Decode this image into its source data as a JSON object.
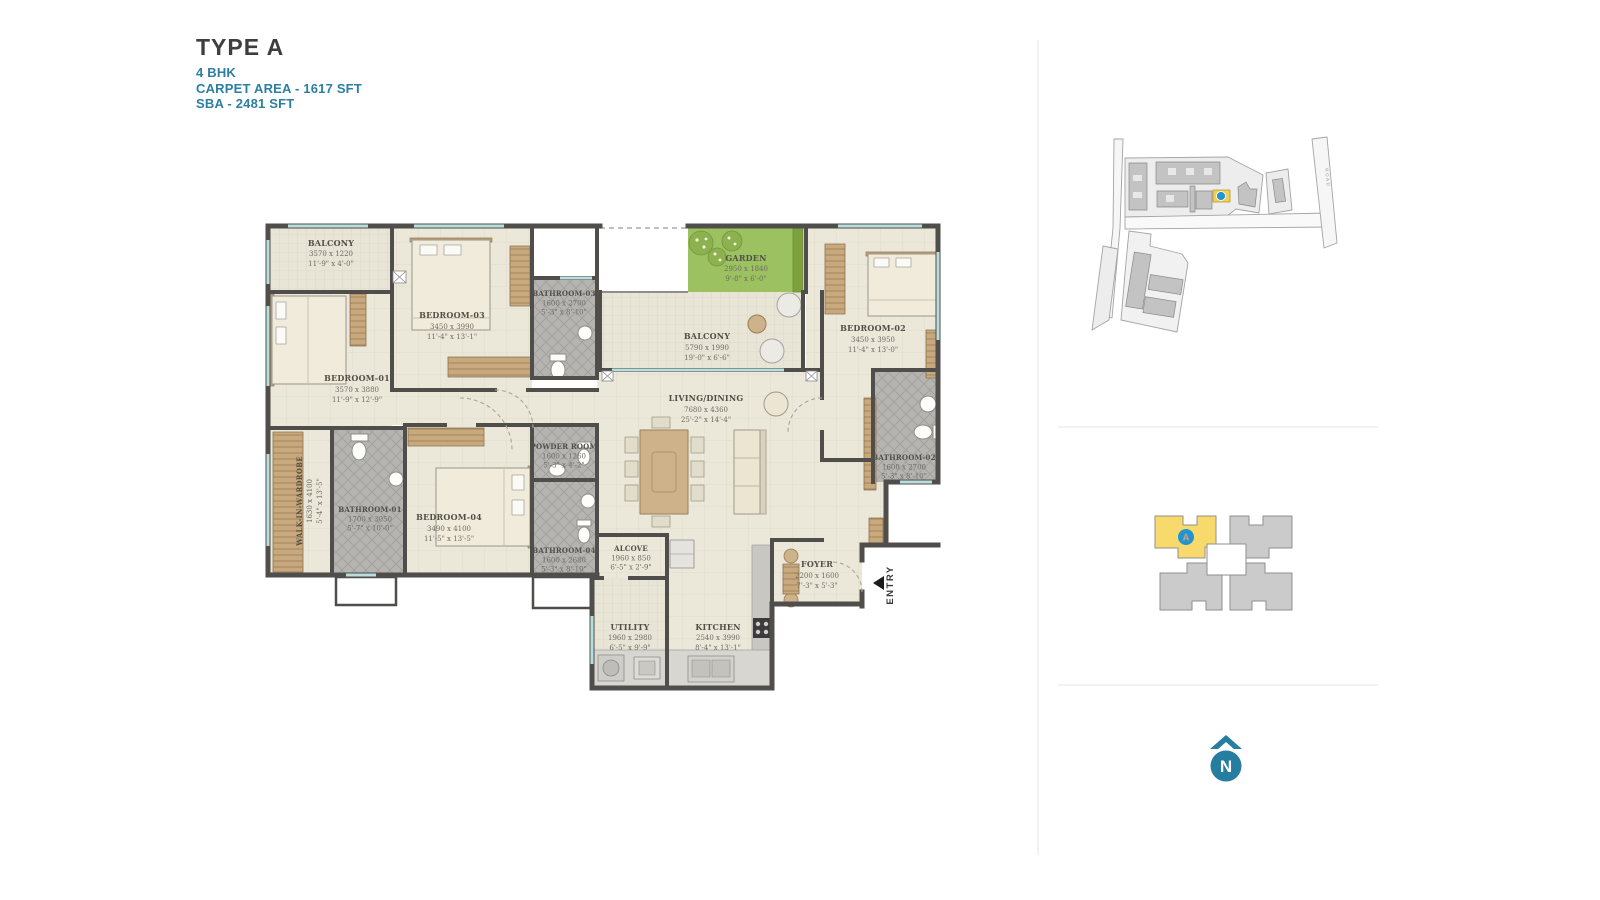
{
  "header": {
    "title": "TYPE A",
    "subtitle": "4 BHK",
    "carpet_area": "CARPET AREA - 1617 SFT",
    "sba": "SBA - 2481 SFT"
  },
  "floor_plan": {
    "entry_label": "ENTRY",
    "rooms": {
      "balcony_top": {
        "name": "BALCONY",
        "mm": "3570 x 1220",
        "ft": "11'-9\" x 4'-0\""
      },
      "bedroom_01": {
        "name": "BEDROOM-01",
        "mm": "3570 x 3880",
        "ft": "11'-9\" x 12'-9\""
      },
      "walk_in_wardrobe": {
        "name": "WALK-IN-WARDROBE",
        "mm": "1630 x 4100",
        "ft": "5'-4\" x 13'-5\""
      },
      "bathroom_01": {
        "name": "BATHROOM-01",
        "mm": "1700 x 3050",
        "ft": "5'-7\" x 10'-0\""
      },
      "bedroom_03": {
        "name": "BEDROOM-03",
        "mm": "3450 x 3990",
        "ft": "11'-4\" x 13'-1\""
      },
      "bathroom_03": {
        "name": "BATHROOM-03",
        "mm": "1600 x 2700",
        "ft": "5'-3\" x 8'-10\""
      },
      "bedroom_04": {
        "name": "BEDROOM-04",
        "mm": "3490 x 4100",
        "ft": "11'-5\" x 13'-5\""
      },
      "powder_room": {
        "name": "POWDER ROOM",
        "mm": "1600 x 1260",
        "ft": "5'-3\" x 4'-2\""
      },
      "bathroom_04": {
        "name": "BATHROOM-04",
        "mm": "1600 x 2680",
        "ft": "5'-3\" x 8'-10\""
      },
      "alcove": {
        "name": "ALCOVE",
        "mm": "1960 x 850",
        "ft": "6'-5\" x 2'-9\""
      },
      "garden": {
        "name": "GARDEN",
        "mm": "2950 x 1840",
        "ft": "9'-8\" x 6'-0\""
      },
      "balcony_main": {
        "name": "BALCONY",
        "mm": "5790 x 1990",
        "ft": "19'-0\" x 6'-6\""
      },
      "living_dining": {
        "name": "LIVING/DINING",
        "mm": "7680 x 4360",
        "ft": "25'-2\" x 14'-4\""
      },
      "bedroom_02": {
        "name": "BEDROOM-02",
        "mm": "3450 x 3950",
        "ft": "11'-4\" x 13'-0\""
      },
      "bathroom_02": {
        "name": "BATHROOM-02",
        "mm": "1600 x 2700",
        "ft": "5'-3\" x 8'-10\""
      },
      "foyer": {
        "name": "FOYER",
        "mm": "2200 x 1600",
        "ft": "7'-3\" x 5'-3\""
      },
      "utility": {
        "name": "UTILITY",
        "mm": "1960 x 2980",
        "ft": "6'-5\" x 9'-9\""
      },
      "kitchen": {
        "name": "KITCHEN",
        "mm": "2540 x 3990",
        "ft": "8'-4\" x 13'-1\""
      }
    }
  },
  "site_map": {
    "road_label": "ROAD"
  },
  "key_plan": {
    "highlighted_unit": "A"
  },
  "north_indicator": {
    "label": "N"
  },
  "colors": {
    "accent_teal": "#2b7fa3",
    "title_gray": "#3e3e3e",
    "wall_gray": "#4f4e4a",
    "floor_beige": "#ebe7d9",
    "bath_tile_gray": "#b6b4b1",
    "garden_green": "#9cc161",
    "wood_tan": "#c8a97d",
    "window_teal": "#b9dedd",
    "highlight_yellow": "#f8da6c",
    "marker_blue": "#1f96d0",
    "north_teal": "#257d9f"
  }
}
